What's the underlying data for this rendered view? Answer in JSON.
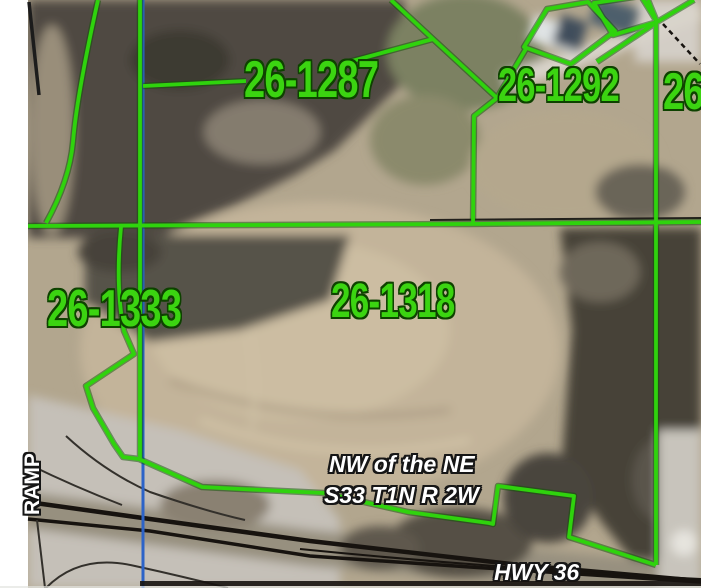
{
  "map": {
    "type": "gis-parcel-aerial-view",
    "colors": {
      "parcel_line_green": "#2fd30d",
      "parcel_label_green": "#3bd411",
      "label_outline_dark_green": "#0e4200",
      "section_line_blue": "#2c63c8",
      "road_black": "#17130f",
      "road_label_white": "#ffffff"
    },
    "parcel_labels": {
      "p1287": "26-1287",
      "p1292": "26-1292",
      "p_right_partial": "26",
      "p1333": "26-1333",
      "p1318": "26-1318"
    },
    "annotations": {
      "section_note_line1": "NW of the NE",
      "section_note_line2": "S33 T1N R 2W",
      "ramp_label": "RAMP",
      "highway_label": "HWY 36"
    }
  }
}
